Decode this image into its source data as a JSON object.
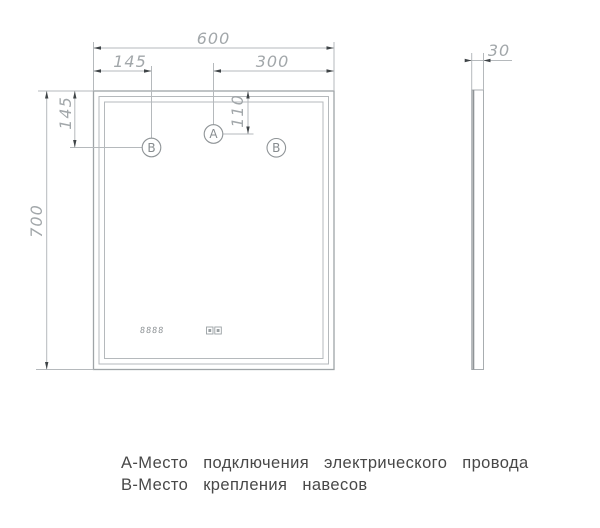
{
  "drawing": {
    "front_view": {
      "dim_width": "600",
      "dim_height": "700",
      "dim_hinge_from_left": "145",
      "dim_hinge_from_top": "145",
      "dim_center_to_right": "300",
      "dim_outlet_from_top": "110",
      "marker_a": "А",
      "marker_b_left": "В",
      "marker_b_right": "В",
      "clock_display": "8888"
    },
    "side_view": {
      "dim_thickness": "30"
    },
    "legend": {
      "line_a": "А-Место подключения электрического провода",
      "line_b": "В-Место крепления навесов"
    },
    "colors": {
      "line": "#b5b9bc",
      "line_dark": "#9fa4a7",
      "arrow": "#3f4447",
      "dim_text": "#a2a7aa",
      "marker_text": "#878c8f",
      "legend_text": "#484848"
    }
  }
}
